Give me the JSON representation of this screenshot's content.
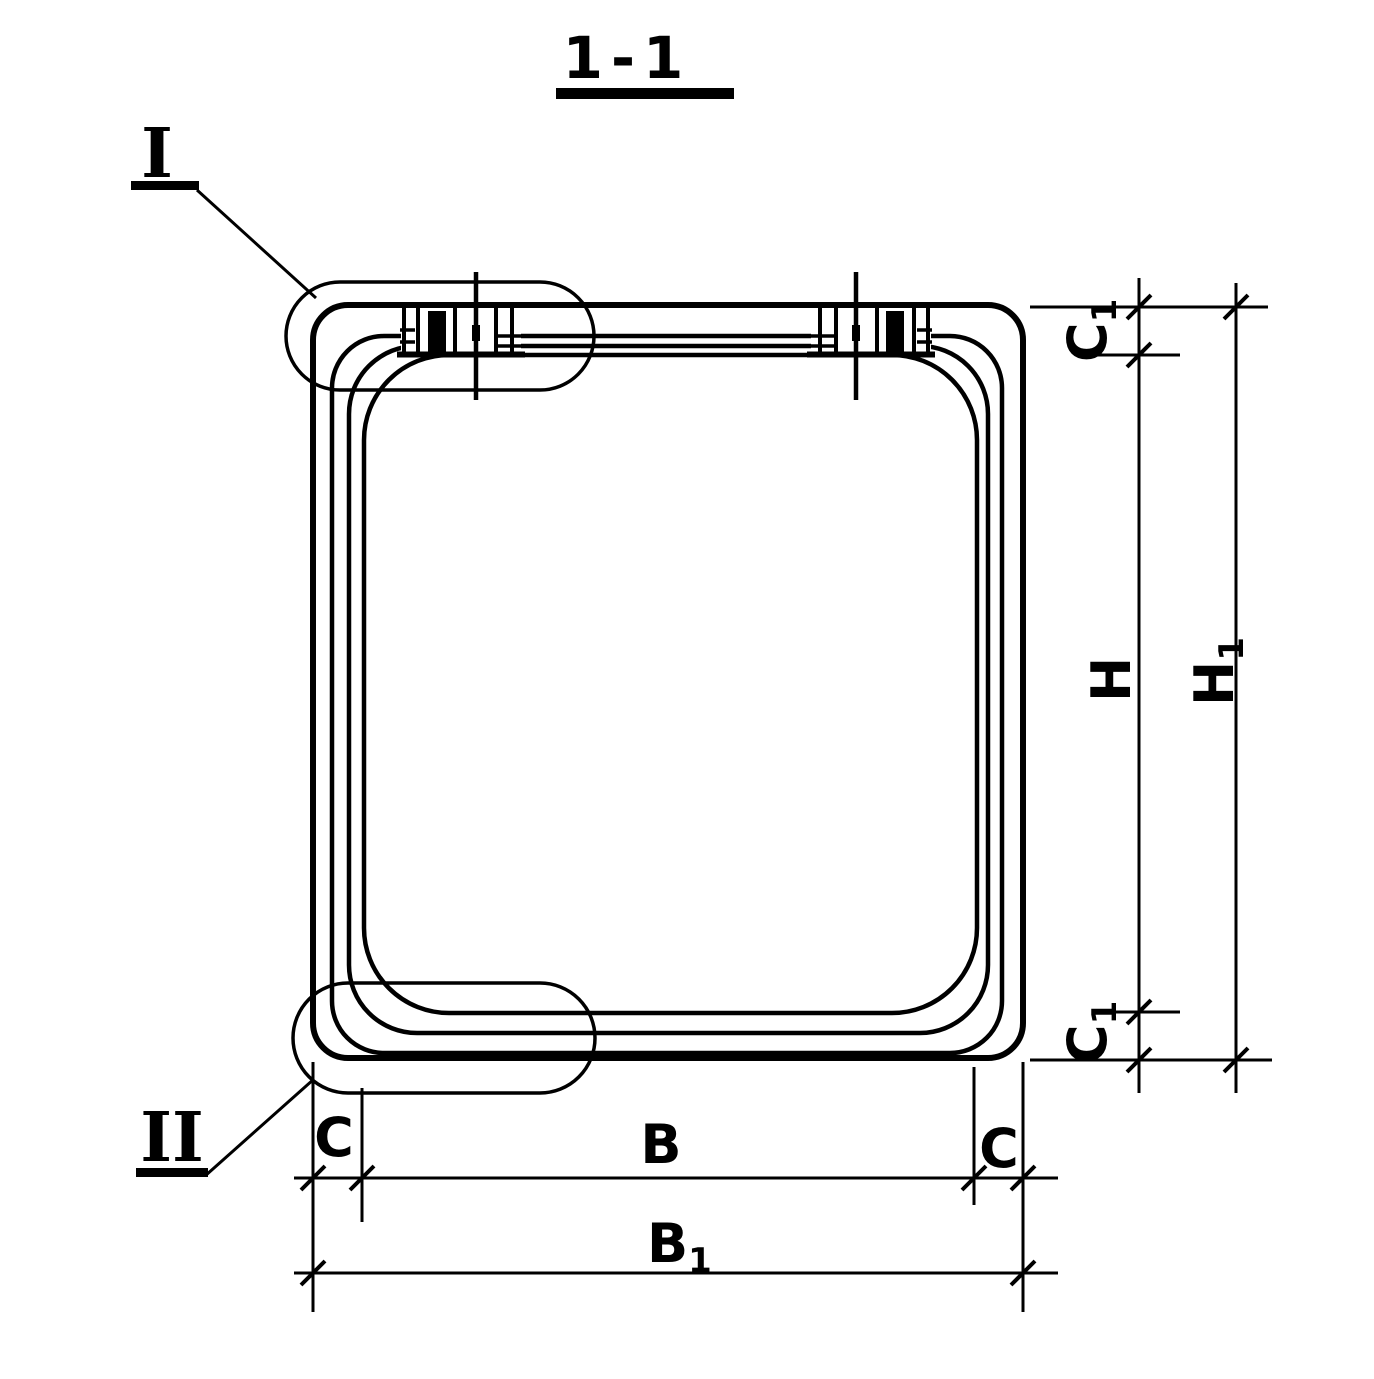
{
  "colors": {
    "ink": "#000000",
    "paper": "#ffffff"
  },
  "title": {
    "label": "1-1"
  },
  "details": {
    "detail_1_label": "I",
    "detail_2_label": "II"
  },
  "dimensions": {
    "c1_top": {
      "base": "C",
      "sub": "1"
    },
    "h": {
      "base": "H",
      "sub": ""
    },
    "h1": {
      "base": "H",
      "sub": "1"
    },
    "c1_bottom": {
      "base": "C",
      "sub": "1"
    },
    "c_left": {
      "base": "C",
      "sub": ""
    },
    "b": {
      "base": "B",
      "sub": ""
    },
    "c_right": {
      "base": "C",
      "sub": ""
    },
    "b1": {
      "base": "B",
      "sub": "1"
    }
  }
}
